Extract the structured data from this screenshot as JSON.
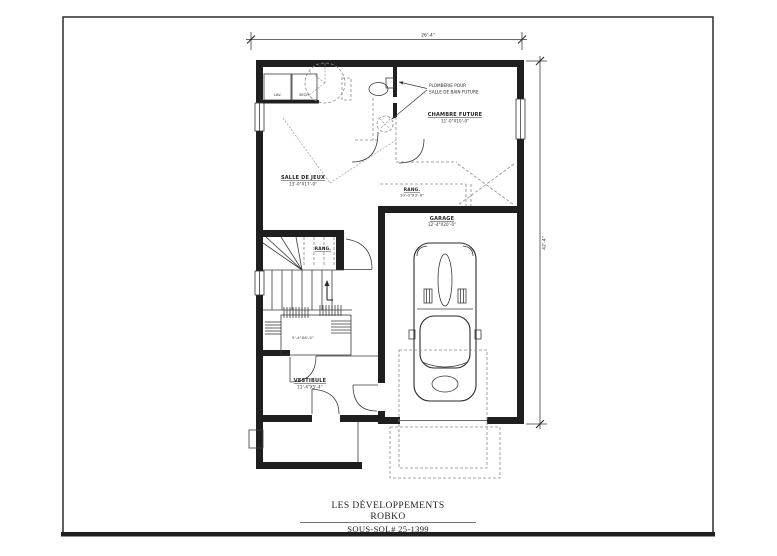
{
  "sheet": {
    "dim_top": "26'-4\"",
    "dim_right": "42'-4\""
  },
  "rooms": {
    "salle_de_jeux": {
      "name": "SALLE DE JEUX",
      "size": "13'-0\"X17'-0\""
    },
    "chambre_future": {
      "name": "CHAMBRE FUTURE",
      "size": "11'-0\"X10'-0\""
    },
    "rang_storage": {
      "name": "RANG.",
      "size": "10'-0\"X3'-0\""
    },
    "garage": {
      "name": "GARAGE",
      "size": "12'-4\"X20'-0\""
    },
    "rang_stairs": {
      "name": "RANG."
    },
    "vestibule": {
      "name": "VESTIBULE",
      "size": "11'-4\"X5'-4\""
    },
    "mech_room": {
      "size": "5'-4\"X6'-0\""
    }
  },
  "notes": {
    "plumbing_line1": "PLOMBERIE POUR",
    "plumbing_line2": "SALLE DE BAIN FUTURE"
  },
  "appliances": {
    "washer": "LAV.",
    "dryer": "SECH."
  },
  "title_block": {
    "company_line1": "LES DÉVELOPPEMENTS",
    "company_line2": "ROBKO",
    "sheet_name": "SOUS-SOL",
    "project_number": "# 25-1399"
  },
  "colors": {
    "ink": "#1f1f1f",
    "paper": "#ffffff"
  }
}
